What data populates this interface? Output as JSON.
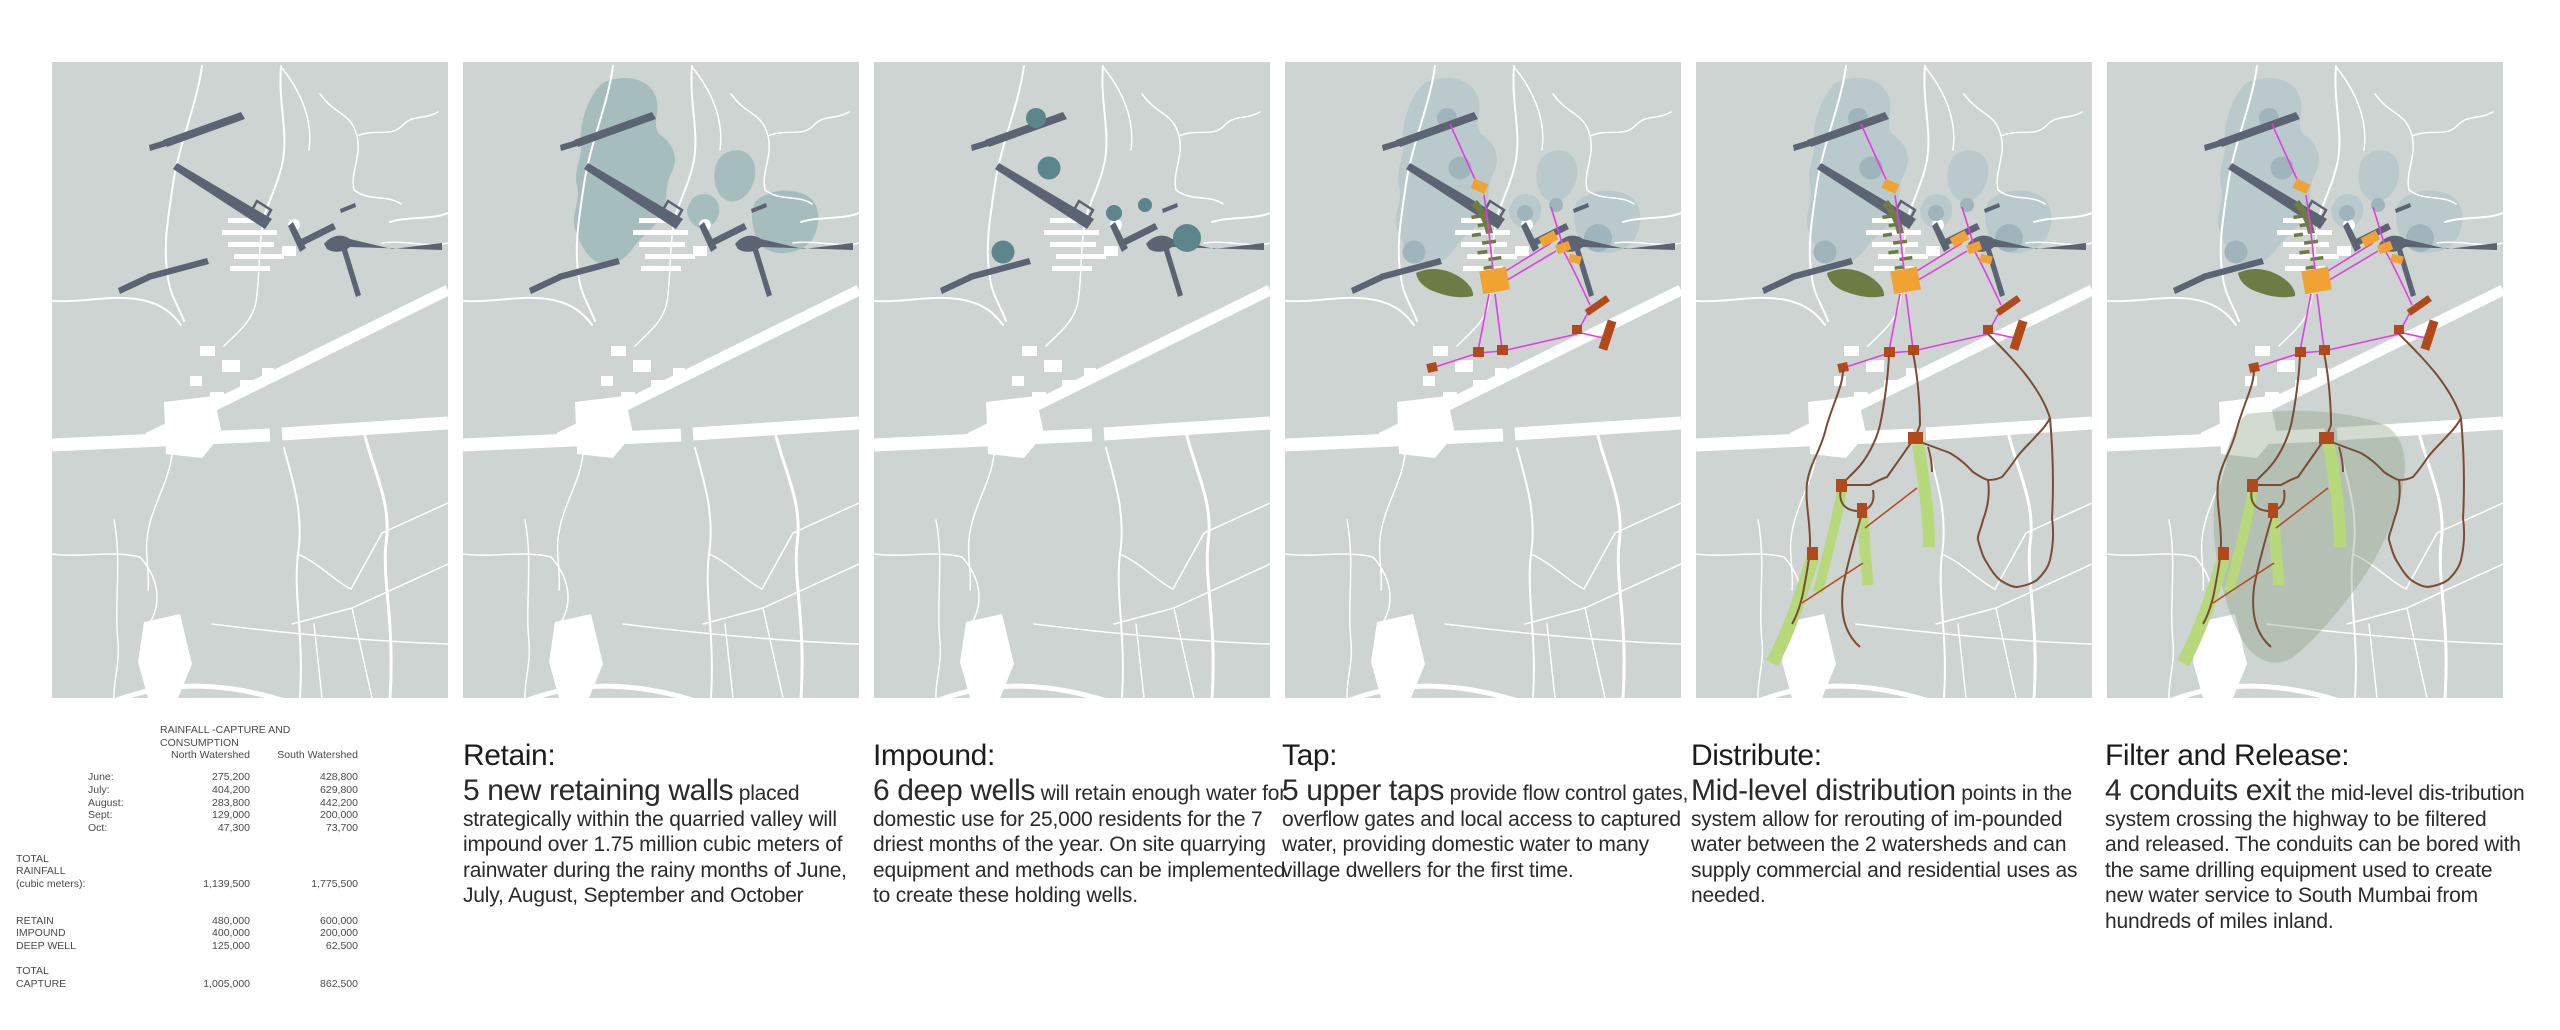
{
  "board_title": "water infrastructure phasing board",
  "table": {
    "title": "RAINFALL -CAPTURE AND CONSUMPTION",
    "col_north": "North Watershed",
    "col_south": "South Watershed",
    "monthly": [
      {
        "label": "June:",
        "north": "275,200",
        "south": "428,800"
      },
      {
        "label": "July:",
        "north": "404,200",
        "south": "629,800"
      },
      {
        "label": "August:",
        "north": "283,800",
        "south": "442,200"
      },
      {
        "label": "Sept:",
        "north": "129,000",
        "south": "200,000"
      },
      {
        "label": "Oct:",
        "north": "47,300",
        "south": "73,700"
      }
    ],
    "total_rainfall": {
      "label_lines": [
        "TOTAL",
        "RAINFALL",
        "(cubic meters):"
      ],
      "north": "1,139,500",
      "south": "1,775,500"
    },
    "capture_rows": [
      {
        "label": "RETAIN",
        "north": "480,000",
        "south": "600,000"
      },
      {
        "label": "IMPOUND",
        "north": "400,000",
        "south": "200,000"
      },
      {
        "label": "DEEP WELL",
        "north": "125,000",
        "south": "62,500"
      }
    ],
    "total_capture": {
      "label_lines": [
        "TOTAL",
        "CAPTURE"
      ],
      "north": "1,005,000",
      "south": "862,500"
    }
  },
  "captions": [
    {
      "title": "Retain:",
      "lead": "5 new retaining walls",
      "body": " placed strategically within the quarried valley will impound over 1.75 million cubic meters of rainwater during the rainy months of June, July, August, September and October"
    },
    {
      "title": "Impound:",
      "lead": "6 deep wells",
      "body": " will retain enough water for domestic use for 25,000 residents for the 7 driest months of the year. On site quarrying equipment and methods can be implemented to create these holding wells."
    },
    {
      "title": "Tap:",
      "lead": "5 upper taps",
      "body": " provide flow control gates, overflow gates and local access to captured water, providing domestic water to many village dwellers for the first time."
    },
    {
      "title": "Distribute:",
      "lead": "Mid-level distribution",
      "body": " points in the system allow for rerouting of im-pounded water between the 2 watersheds and can supply commercial and residential uses as needed."
    },
    {
      "title": "Filter and Release:",
      "lead": "4 conduits exit",
      "body": " the mid-level dis-tribution system crossing the highway to be filtered and released. The conduits can be bored with the same drilling equipment used to create new water service to South Mumbai from hundreds of miles inland."
    }
  ],
  "panels": [
    {
      "id": "retain",
      "layers": [
        "base-map",
        "retaining-walls"
      ]
    },
    {
      "id": "impound-areas",
      "layers": [
        "base-map",
        "watershed-areas",
        "retaining-walls"
      ]
    },
    {
      "id": "deep-wells",
      "layers": [
        "base-map",
        "retaining-walls",
        "deep-wells"
      ]
    },
    {
      "id": "tap",
      "layers": [
        "base-map",
        "watershed-areas",
        "deep-wells",
        "retaining-walls",
        "quarry-valleys",
        "tap-network"
      ]
    },
    {
      "id": "distribute",
      "layers": [
        "base-map",
        "watershed-areas",
        "deep-wells",
        "retaining-walls",
        "quarry-valleys",
        "tap-network",
        "distribution-network"
      ]
    },
    {
      "id": "filter-release",
      "layers": [
        "base-map",
        "watershed-areas",
        "deep-wells",
        "retaining-walls",
        "quarry-valleys",
        "tap-network",
        "filter-zone",
        "distribution-network"
      ]
    }
  ],
  "colors": {
    "page_background": "#ffffff",
    "map_background": "#cdd4d2",
    "roads": "#ffffff",
    "retaining_walls": "#5c6372",
    "watershed_strong": "#a6bdbd",
    "watershed_light": "#bac9cb",
    "deep_well_strong": "#5d868c",
    "deep_well_light": "#a0b4bb",
    "quarry_valley_olive": "#6d7b44",
    "tap_lines_magenta": "#e23ee2",
    "upper_taps_orange": "#f0a232",
    "gates_rust": "#b2491b",
    "distribution_brown": "#7b4b33",
    "release_strips_green": "#b8d87c",
    "filter_zone_green": "#8ba083"
  }
}
